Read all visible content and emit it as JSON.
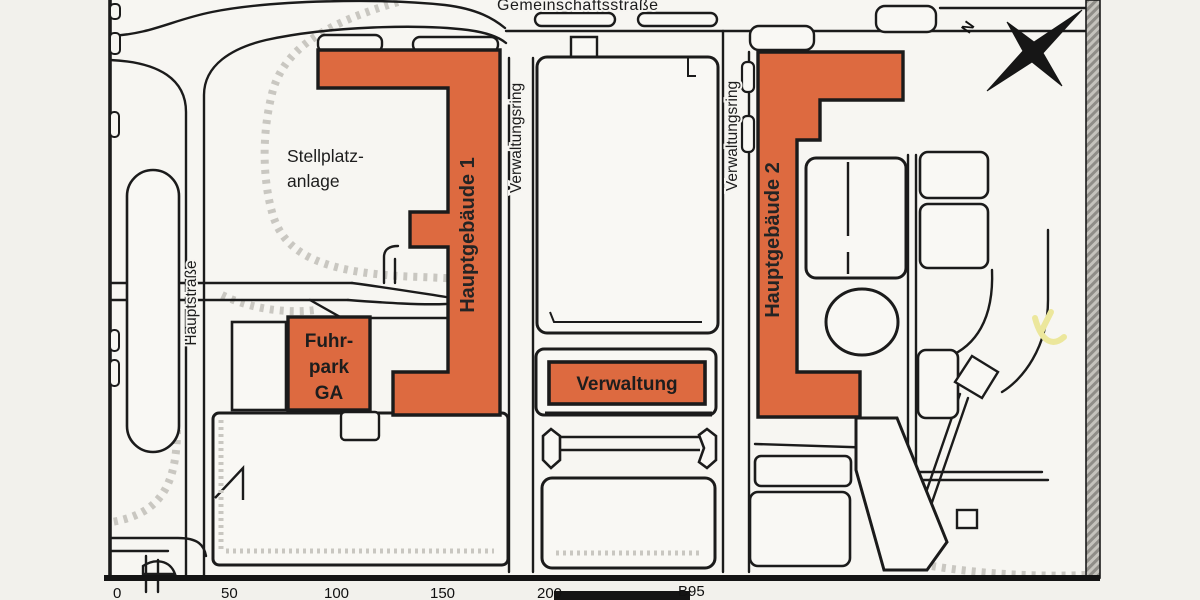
{
  "map": {
    "title_hint": "site plan scan",
    "streets": {
      "gemeinschaftsstrasse": "Gemeinschaftsstraße",
      "verwaltungsring": "Verwaltungsring",
      "hauptstrasse": "Hauptstraße",
      "b95": "B95"
    },
    "areas": {
      "stellplatz_line1": "Stellplatz-",
      "stellplatz_line2": "anlage"
    },
    "buildings": {
      "hauptgebaeude1": "Hauptgebäude 1",
      "hauptgebaeude2": "Hauptgebäude 2",
      "verwaltung": "Verwaltung",
      "fuhrpark_line1": "Fuhr-",
      "fuhrpark_line2": "park",
      "fuhrpark_line3": "GA"
    },
    "compass": {
      "north": "N"
    },
    "scale": {
      "ticks": [
        "0",
        "50",
        "100",
        "150",
        "200"
      ]
    },
    "colors": {
      "building_fill": "#dd6a40",
      "outline": "#1b1b1b",
      "hatch_gray": "#c9c7c1",
      "frame_band": "#b9b7b1",
      "paper": "#f2f1ec",
      "highlight_yellow": "#ece79c"
    }
  }
}
